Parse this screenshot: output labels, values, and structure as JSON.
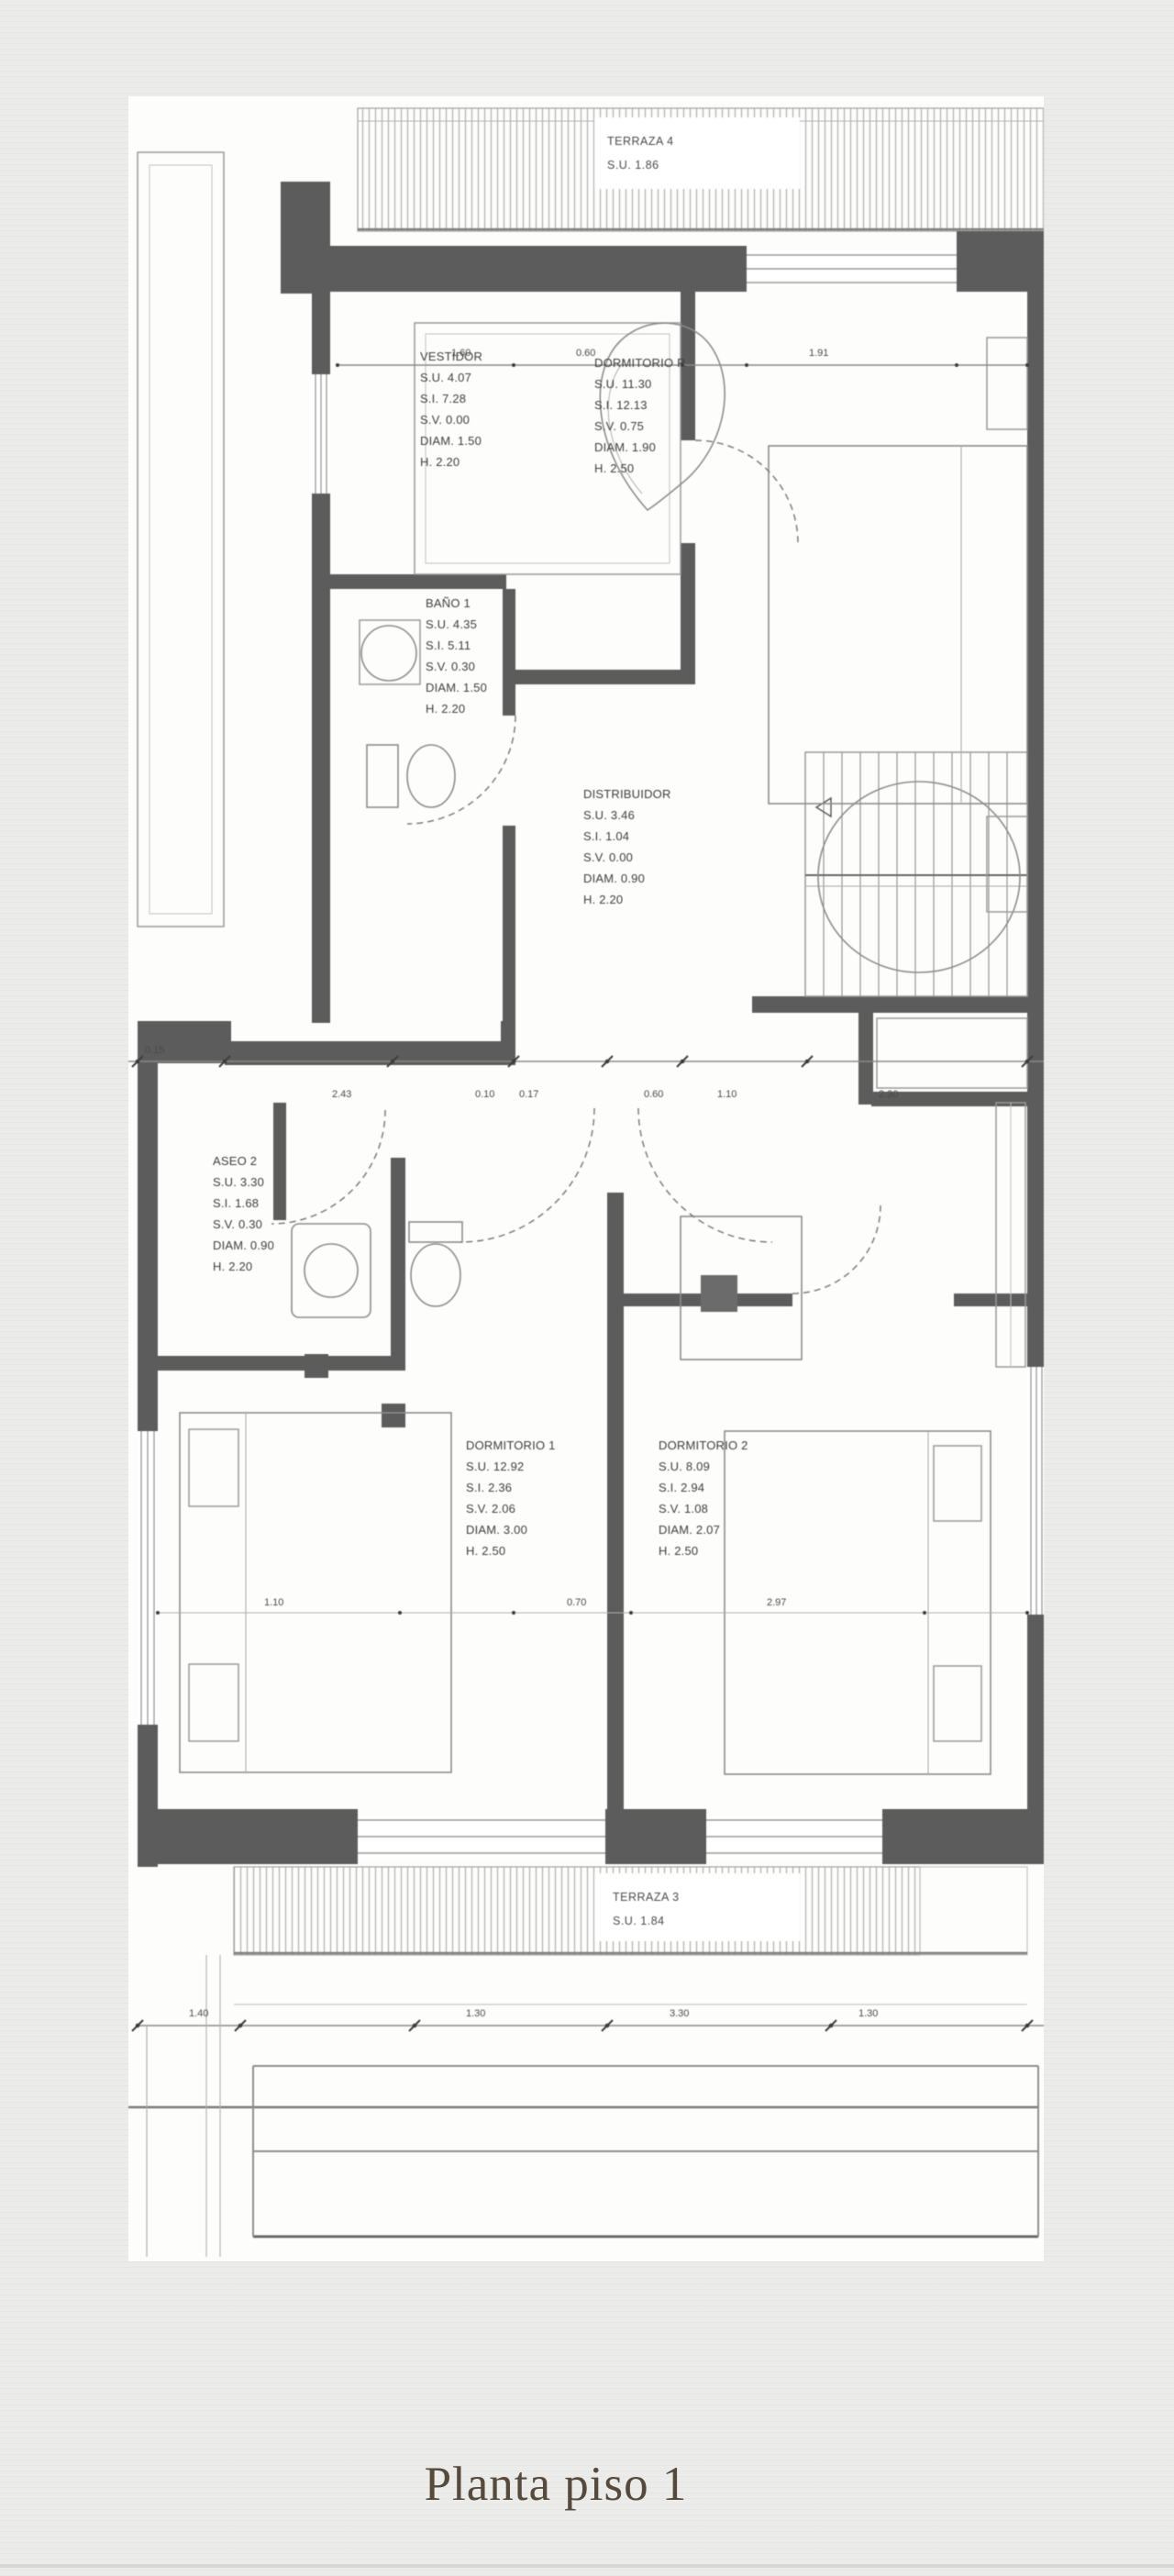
{
  "page": {
    "caption": "Planta piso 1"
  },
  "plan": {
    "terraces": [
      {
        "name": "TERRAZA 4",
        "area": "S.U. 1.86"
      },
      {
        "name": "TERRAZA 3",
        "area": "S.U. 1.84"
      }
    ],
    "rooms": [
      {
        "name": "VESTIDOR",
        "lines": [
          "S.U. 4.07",
          "S.I. 7.28",
          "S.V. 0.00",
          "DIAM. 1.50",
          "H. 2.20"
        ]
      },
      {
        "name": "DORMITORIO P.",
        "lines": [
          "S.U. 11.30",
          "S.I. 12.13",
          "S.V. 0.75",
          "DIAM. 1.90",
          "H. 2.50"
        ]
      },
      {
        "name": "BAÑO 1",
        "lines": [
          "S.U. 4.35",
          "S.I. 5.11",
          "S.V. 0.30",
          "DIAM. 1.50",
          "H. 2.20"
        ]
      },
      {
        "name": "DISTRIBUIDOR",
        "lines": [
          "S.U. 3.46",
          "S.I. 1.04",
          "S.V. 0.00",
          "DIAM. 0.90",
          "H. 2.20"
        ]
      },
      {
        "name": "ASEO 2",
        "lines": [
          "S.U. 3.30",
          "S.I. 1.68",
          "S.V. 0.30",
          "DIAM. 0.90",
          "H. 2.20"
        ]
      },
      {
        "name": "DORMITORIO 1",
        "lines": [
          "S.U. 12.92",
          "S.I. 2.36",
          "S.V. 2.06",
          "DIAM. 3.00",
          "H. 2.50"
        ]
      },
      {
        "name": "DORMITORIO 2",
        "lines": [
          "S.U. 8.09",
          "S.I. 2.94",
          "S.V. 1.08",
          "DIAM. 2.07",
          "H. 2.50"
        ]
      }
    ],
    "dimensions": {
      "top": [
        "1.60",
        "0.60",
        "1.91"
      ],
      "middle": [
        "0.15",
        "2.43",
        "0.10",
        "0.17",
        "0.60",
        "1.10",
        "2.30"
      ],
      "room": [
        "1.10",
        "0.70",
        "2.97"
      ],
      "bottom": [
        "1.40",
        "1.30",
        "3.30",
        "1.30"
      ],
      "left": [
        "0.40"
      ]
    }
  }
}
